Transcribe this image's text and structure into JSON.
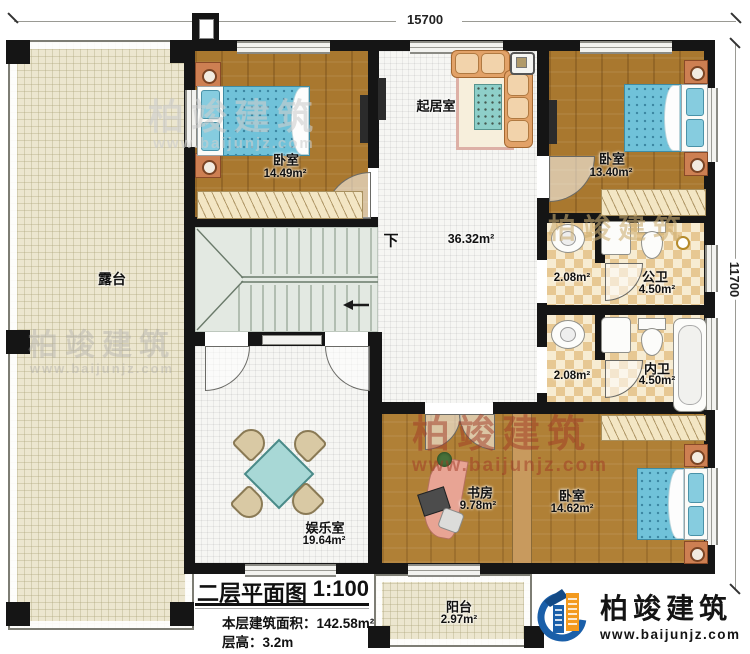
{
  "dimensions": {
    "width_label": "15700",
    "height_label": "11700"
  },
  "stairs": {
    "down": "下"
  },
  "rooms": {
    "terrace": {
      "name": "露台"
    },
    "bedroom_tl": {
      "name": "卧室",
      "area": "14.49m²"
    },
    "living": {
      "name": "起居室",
      "area": "36.32m²"
    },
    "bedroom_tr": {
      "name": "卧室",
      "area": "13.40m²"
    },
    "wash_upper": {
      "area": "2.08m²"
    },
    "public_bath": {
      "name": "公卫",
      "area": "4.50m²"
    },
    "wash_lower": {
      "area": "2.08m²"
    },
    "ensuite_bath": {
      "name": "内卫",
      "area": "4.50m²"
    },
    "study": {
      "name": "书房",
      "area": "9.78m²"
    },
    "bedroom_br": {
      "name": "卧室",
      "area": "14.62m²"
    },
    "game_room": {
      "name": "娱乐室",
      "area": "19.64m²"
    },
    "balcony": {
      "name": "阳台",
      "area": "2.97m²"
    }
  },
  "title_block": {
    "title": "二层平面图",
    "scale": "1:100",
    "area_label": "本层建筑面积：",
    "area_value": "142.58m²",
    "floor_height_label": "层高：",
    "floor_height_value": "3.2m"
  },
  "brand": {
    "name": "柏竣建筑",
    "website": "www.baijunjz.com"
  },
  "watermark": {
    "name": "柏竣建筑",
    "website": "www.baijunjz.com"
  },
  "colors": {
    "wall": "#151515",
    "wood_floor": "#a9782f",
    "terrace_floor": "#ece6cf",
    "tile": "#e7c893",
    "stair": "#e3e9e2",
    "bed_blue": "#70c2d9",
    "brand_blue": "#1a5fa9",
    "brand_orange": "#f39a1e"
  }
}
